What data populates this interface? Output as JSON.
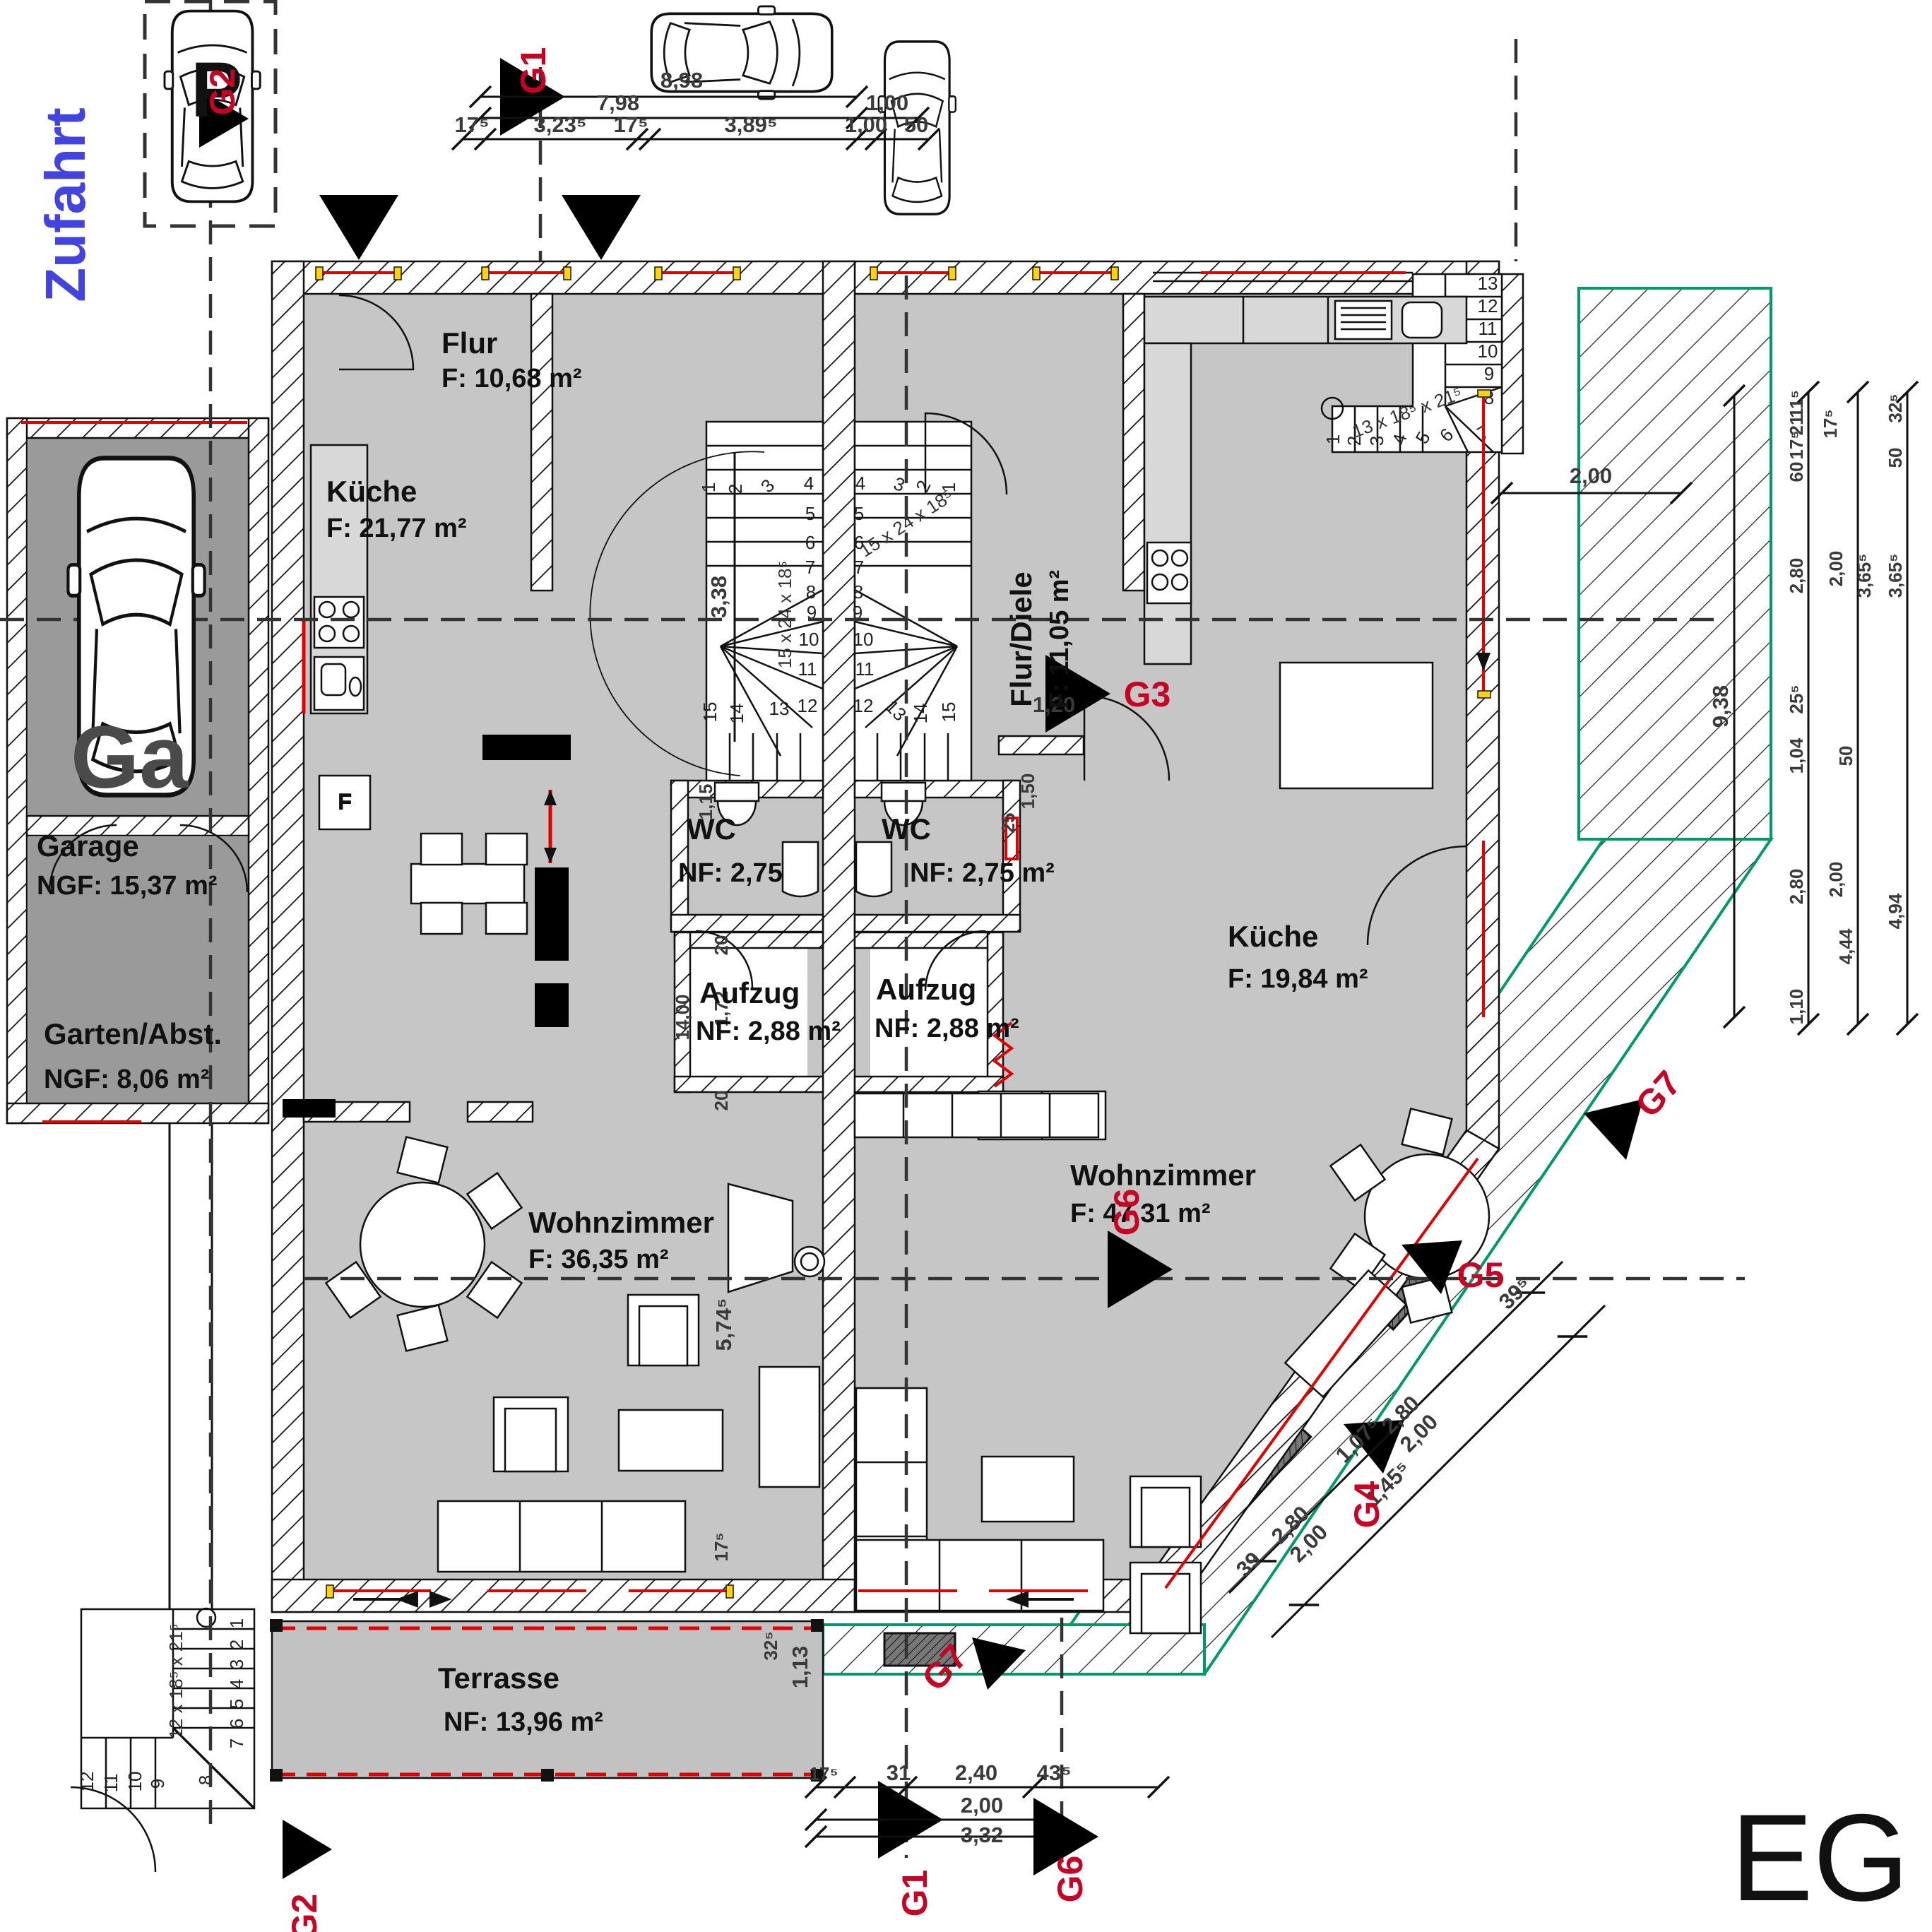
{
  "title": {
    "floor": "EG"
  },
  "site": {
    "zufahrt": "Zufahrt",
    "parking_letter": "P",
    "garage_letter": "Ga",
    "fridge_letter": "F"
  },
  "colors": {
    "label_red": "#c70024",
    "line_red": "#e00000",
    "zufahrt_blue": "#4343e0",
    "deck_green": "#009a6a",
    "jamb_yellow": "#ffd400",
    "room_gray": "#c6c6c6",
    "garage_gray": "#9a9a9a"
  },
  "rooms": {
    "garage": {
      "name": "Garage",
      "area": "NGF: 15,37 m²"
    },
    "garten": {
      "name": "Garten/Abst.",
      "area": "NGF: 8,06 m²"
    },
    "flur_left": {
      "name": "Flur",
      "area": "F: 10,68 m²"
    },
    "kueche_left": {
      "name": "Küche",
      "area": "F: 21,77 m²"
    },
    "wc_left": {
      "name": "WC",
      "area": "NF: 2,75"
    },
    "wc_right": {
      "name": "WC",
      "area": "NF: 2,75 m²"
    },
    "aufzug_left": {
      "name": "Aufzug",
      "area": "NF: 2,88 m²"
    },
    "aufzug_right": {
      "name": "Aufzug",
      "area": "NF: 2,88 m²"
    },
    "wohnzimmer_left": {
      "name": "Wohnzimmer",
      "area": "F:    36,35 m²"
    },
    "wohnzimmer_right": {
      "name": "Wohnzimmer",
      "area": "F:    47,31 m²"
    },
    "terrasse": {
      "name": "Terrasse",
      "area": "NF: 13,96 m²"
    },
    "flur_diele_right": {
      "name": "Flur/Diele",
      "area": "F: 11,05 m²"
    },
    "kueche_right": {
      "name": "Küche",
      "area": "F: 19,84 m²"
    }
  },
  "markers": {
    "g1": "G1",
    "g2": "G2",
    "g3": "G3",
    "g4": "G4",
    "g5": "G5",
    "g6": "G6",
    "g7": "G7"
  },
  "dims": {
    "top": [
      "8,98",
      "7,98",
      "1,00",
      "17⁵",
      "3,23⁵",
      "17⁵",
      "3,89⁵",
      "1,00",
      "50"
    ],
    "right_walk": "2,00",
    "right_overall": "9,38",
    "right_chain1": [
      "11⁵",
      "21",
      "17⁵",
      "60",
      "2,80",
      "25⁵",
      "1,04",
      "2,80",
      "1,10"
    ],
    "right_chain2": [
      "17⁵",
      "2,00",
      "50",
      "2,00",
      "4,44"
    ],
    "right_chain3": [
      "32⁵",
      "50",
      "3,65⁵",
      "3,65⁵",
      "4,94"
    ],
    "core": [
      "3,38",
      "1,15",
      "20",
      "1,72",
      "14,00",
      "20"
    ],
    "left_unit": [
      "5,74⁵",
      "17⁵",
      "32⁵",
      "1,13"
    ],
    "right_unit": [
      "1,20",
      "1,50",
      "25"
    ],
    "bottom": [
      "17⁵",
      "31",
      "2,40",
      "43⁵",
      "2,00",
      "3,32"
    ],
    "diagonal": [
      "2,80",
      "2,00",
      "2,80",
      "2,00",
      "39",
      "39⁵",
      "1,45⁵",
      "1,07⁵"
    ]
  },
  "stairs": {
    "int_left": {
      "annotation": "15 x 24 x 18⁵",
      "steps": [
        "1",
        "2",
        "3",
        "4",
        "5",
        "6",
        "7",
        "8",
        "9",
        "10",
        "11",
        "12",
        "13",
        "14",
        "15"
      ]
    },
    "int_right": {
      "annotation": "15 x 24 x 18⁵",
      "steps": [
        "1",
        "2",
        "3",
        "4",
        "5",
        "6",
        "7",
        "8",
        "9",
        "10",
        "11",
        "12",
        "13",
        "14",
        "15"
      ]
    },
    "ext_top": {
      "annotation": "13 x 18⁵ x 21⁵",
      "steps": [
        "1",
        "2",
        "3",
        "4",
        "5",
        "6",
        "7",
        "8",
        "9",
        "10",
        "11",
        "12",
        "13"
      ]
    },
    "ext_bottom": {
      "annotation": "12 x 18⁵ x 21⁵",
      "steps": [
        "1",
        "2",
        "3",
        "4",
        "5",
        "6",
        "7",
        "8",
        "9",
        "10",
        "11",
        "12"
      ]
    }
  }
}
